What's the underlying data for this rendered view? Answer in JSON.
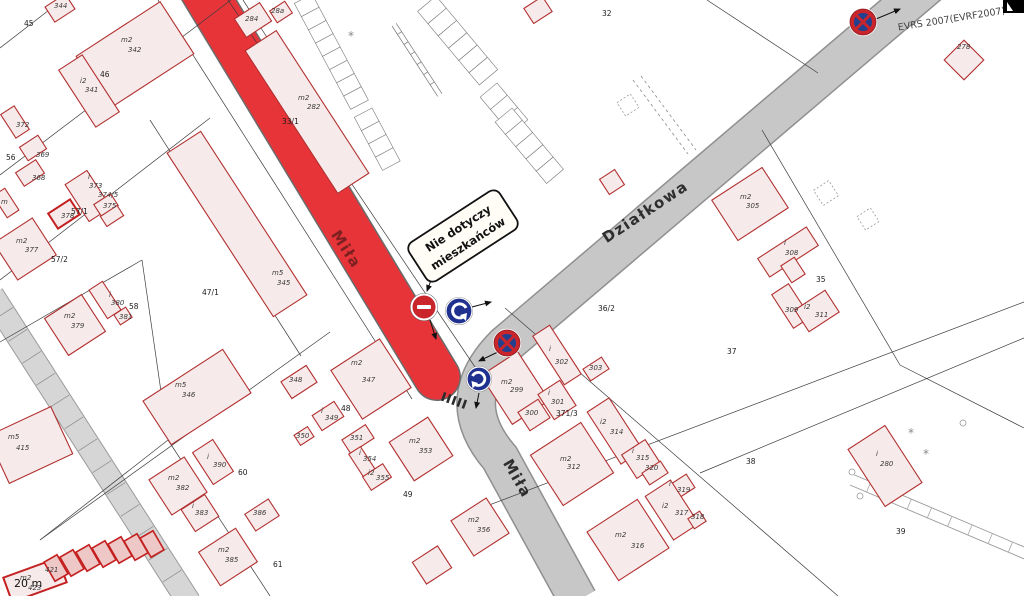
{
  "streets": {
    "mila_north": "Miła",
    "dzialkowa": "Działkowa",
    "mila_south": "Miła"
  },
  "annotation": {
    "line1": "Nie dotyczy",
    "line2": "mieszkańców"
  },
  "datum_note": "EVRS 2007(EVRF2007)",
  "scale_label": "20 m",
  "colors": {
    "closed_road": "#e73439",
    "road": "#c7c7c7",
    "building_fill": "#f7eaea",
    "building_stroke": "#b23030",
    "sign_blue": "#20308f",
    "sign_red": "#c9252b"
  },
  "signs": [
    {
      "name": "no-entry-sign",
      "x": 424,
      "y": 307
    },
    {
      "name": "mandatory-direction-left-sign",
      "x": 459,
      "y": 311
    },
    {
      "name": "no-stopping-sign",
      "x": 507,
      "y": 343
    },
    {
      "name": "mandatory-direction-right-sign",
      "x": 479,
      "y": 379
    },
    {
      "name": "no-stopping-sign",
      "x": 863,
      "y": 22
    }
  ],
  "map_geometry": {
    "buildings": [
      [
        135,
        55,
        100,
        62,
        -33
      ],
      [
        89,
        91,
        28,
        68,
        -33
      ],
      [
        60,
        8,
        24,
        18,
        -33
      ],
      [
        253,
        20,
        30,
        22,
        -33
      ],
      [
        281,
        12,
        18,
        14,
        -33
      ],
      [
        307,
        112,
        170,
        37,
        57
      ],
      [
        237,
        224,
        195,
        40,
        57
      ],
      [
        197,
        397,
        95,
        52,
        -33
      ],
      [
        25,
        249,
        46,
        44,
        -33
      ],
      [
        75,
        325,
        44,
        44,
        -33
      ],
      [
        88,
        196,
        26,
        44,
        -33
      ],
      [
        106,
        205,
        20,
        14,
        -33
      ],
      [
        112,
        216,
        20,
        12,
        -33
      ],
      [
        64,
        214,
        26,
        18,
        -33,
        "bold"
      ],
      [
        33,
        148,
        22,
        16,
        -33
      ],
      [
        30,
        173,
        24,
        16,
        -33
      ],
      [
        15,
        122,
        16,
        28,
        -33
      ],
      [
        6,
        203,
        14,
        26,
        -33
      ],
      [
        105,
        300,
        16,
        34,
        -33
      ],
      [
        123,
        316,
        14,
        12,
        -33
      ],
      [
        299,
        382,
        30,
        20,
        -33
      ],
      [
        371,
        379,
        58,
        58,
        -33
      ],
      [
        328,
        416,
        26,
        18,
        -33
      ],
      [
        304,
        436,
        16,
        12,
        -33
      ],
      [
        358,
        439,
        28,
        16,
        -33
      ],
      [
        366,
        468,
        42,
        14,
        57
      ],
      [
        377,
        477,
        24,
        16,
        -33
      ],
      [
        421,
        449,
        46,
        46,
        -33
      ],
      [
        178,
        486,
        42,
        42,
        -33
      ],
      [
        200,
        513,
        28,
        26,
        -33
      ],
      [
        213,
        462,
        38,
        24,
        57
      ],
      [
        228,
        557,
        44,
        40,
        -33
      ],
      [
        262,
        515,
        28,
        20,
        -33
      ],
      [
        30,
        445,
        70,
        52,
        -25
      ],
      [
        35,
        580,
        58,
        26,
        -20,
        "bold"
      ],
      [
        56,
        568,
        15,
        22,
        -30,
        "hb"
      ],
      [
        72,
        563,
        15,
        22,
        -30,
        "hb"
      ],
      [
        88,
        558,
        15,
        22,
        -30,
        "hb"
      ],
      [
        104,
        554,
        15,
        22,
        -30,
        "hb"
      ],
      [
        120,
        550,
        15,
        22,
        -30,
        "hb"
      ],
      [
        136,
        547,
        15,
        22,
        -30,
        "hb"
      ],
      [
        152,
        544,
        15,
        22,
        -30,
        "hb"
      ],
      [
        432,
        565,
        30,
        26,
        -33
      ],
      [
        480,
        527,
        42,
        42,
        -33
      ],
      [
        572,
        464,
        60,
        60,
        -33
      ],
      [
        615,
        431,
        26,
        62,
        -33
      ],
      [
        641,
        459,
        28,
        28,
        -33
      ],
      [
        655,
        473,
        22,
        14,
        -33
      ],
      [
        678,
        489,
        30,
        16,
        -33
      ],
      [
        672,
        510,
        30,
        52,
        -33
      ],
      [
        697,
        520,
        14,
        12,
        -33
      ],
      [
        628,
        540,
        60,
        58,
        -33
      ],
      [
        515,
        388,
        44,
        58,
        -33
      ],
      [
        534,
        415,
        24,
        22,
        -33
      ],
      [
        557,
        400,
        26,
        30,
        -33
      ],
      [
        557,
        355,
        20,
        58,
        -33
      ],
      [
        596,
        369,
        22,
        14,
        -33
      ],
      [
        750,
        204,
        60,
        48,
        -33
      ],
      [
        788,
        252,
        58,
        22,
        -33
      ],
      [
        793,
        270,
        16,
        20,
        -33
      ],
      [
        791,
        306,
        20,
        40,
        -33
      ],
      [
        817,
        311,
        36,
        26,
        -33
      ],
      [
        885,
        466,
        44,
        68,
        -33
      ],
      [
        964,
        60,
        28,
        28,
        -45
      ],
      [
        538,
        10,
        22,
        18,
        -33
      ],
      [
        612,
        182,
        18,
        18,
        -33
      ]
    ],
    "labels": [
      [
        "45",
        24,
        26,
        "p"
      ],
      [
        "46",
        100,
        77,
        "p"
      ],
      [
        "32",
        602,
        16,
        "p"
      ],
      [
        "33/1",
        282,
        124,
        "p"
      ],
      [
        "47/1",
        202,
        295,
        "p"
      ],
      [
        "56",
        6,
        160,
        "p"
      ],
      [
        "57/1",
        71,
        214,
        "p"
      ],
      [
        "57/2",
        51,
        262,
        "p"
      ],
      [
        "58",
        129,
        309,
        "p"
      ],
      [
        "60",
        238,
        475,
        "p"
      ],
      [
        "61",
        273,
        567,
        "p"
      ],
      [
        "48",
        341,
        411,
        "p"
      ],
      [
        "49",
        403,
        497,
        "p"
      ],
      [
        "35",
        816,
        282,
        "p"
      ],
      [
        "36/2",
        598,
        311,
        "p"
      ],
      [
        "37",
        727,
        354,
        "p"
      ],
      [
        "38",
        746,
        464,
        "p"
      ],
      [
        "39",
        896,
        534,
        "p"
      ],
      [
        "371/3",
        556,
        416,
        "p"
      ],
      [
        "m2",
        121,
        42,
        "b"
      ],
      [
        "342",
        128,
        52,
        "b"
      ],
      [
        "i2",
        80,
        83,
        "b"
      ],
      [
        "341",
        85,
        92,
        "b"
      ],
      [
        "344",
        54,
        8,
        "b"
      ],
      [
        "284",
        245,
        21,
        "b"
      ],
      [
        "28a",
        271,
        13,
        "b"
      ],
      [
        "m2",
        298,
        100,
        "b"
      ],
      [
        "282",
        307,
        109,
        "b"
      ],
      [
        "m5",
        272,
        275,
        "b"
      ],
      [
        "345",
        277,
        285,
        "b"
      ],
      [
        "m5",
        175,
        387,
        "b"
      ],
      [
        "346",
        182,
        397,
        "b"
      ],
      [
        "m2",
        16,
        243,
        "b"
      ],
      [
        "377",
        25,
        252,
        "b"
      ],
      [
        "m2",
        64,
        318,
        "b"
      ],
      [
        "379",
        71,
        328,
        "b"
      ],
      [
        "i",
        88,
        179,
        "b"
      ],
      [
        "373",
        89,
        188,
        "b"
      ],
      [
        "374/5",
        98,
        197,
        "b"
      ],
      [
        "375",
        103,
        208,
        "b"
      ],
      [
        "378",
        61,
        218,
        "b"
      ],
      [
        "369",
        36,
        157,
        "b"
      ],
      [
        "368",
        32,
        180,
        "b"
      ],
      [
        "372",
        16,
        127,
        "b"
      ],
      [
        "m",
        1,
        204,
        "b"
      ],
      [
        "i",
        109,
        297,
        "b"
      ],
      [
        "380",
        111,
        305,
        "b"
      ],
      [
        "381",
        119,
        319,
        "b"
      ],
      [
        "348",
        289,
        382,
        "b"
      ],
      [
        "m2",
        351,
        365,
        "b"
      ],
      [
        "347",
        362,
        382,
        "b"
      ],
      [
        "i",
        321,
        413,
        "b"
      ],
      [
        "349",
        325,
        420,
        "b"
      ],
      [
        "350",
        296,
        438,
        "b"
      ],
      [
        "351",
        350,
        440,
        "b"
      ],
      [
        "i",
        359,
        455,
        "b"
      ],
      [
        "354",
        363,
        461,
        "b"
      ],
      [
        "i2",
        368,
        475,
        "b"
      ],
      [
        "355",
        376,
        480,
        "b"
      ],
      [
        "m2",
        409,
        443,
        "b"
      ],
      [
        "353",
        419,
        453,
        "b"
      ],
      [
        "m2",
        168,
        480,
        "b"
      ],
      [
        "382",
        176,
        490,
        "b"
      ],
      [
        "i",
        192,
        508,
        "b"
      ],
      [
        "383",
        195,
        515,
        "b"
      ],
      [
        "i",
        207,
        459,
        "b"
      ],
      [
        "390",
        213,
        467,
        "b"
      ],
      [
        "m2",
        218,
        552,
        "b"
      ],
      [
        "385",
        225,
        562,
        "b"
      ],
      [
        "386",
        253,
        515,
        "b"
      ],
      [
        "m5",
        8,
        439,
        "b"
      ],
      [
        "415",
        16,
        450,
        "b"
      ],
      [
        "421",
        45,
        572,
        "b"
      ],
      [
        "m2",
        20,
        580,
        "b"
      ],
      [
        "423",
        28,
        590,
        "b"
      ],
      [
        "m2",
        468,
        522,
        "b"
      ],
      [
        "356",
        477,
        532,
        "b"
      ],
      [
        "m2",
        560,
        461,
        "b"
      ],
      [
        "312",
        567,
        469,
        "b"
      ],
      [
        "i2",
        600,
        424,
        "b"
      ],
      [
        "314",
        610,
        434,
        "b"
      ],
      [
        "i",
        632,
        453,
        "b"
      ],
      [
        "315",
        636,
        460,
        "b"
      ],
      [
        "320",
        645,
        470,
        "b"
      ],
      [
        "i",
        669,
        486,
        "b"
      ],
      [
        "319",
        677,
        492,
        "b"
      ],
      [
        "i2",
        662,
        508,
        "b"
      ],
      [
        "317",
        675,
        515,
        "b"
      ],
      [
        "318",
        691,
        519,
        "b"
      ],
      [
        "m2",
        615,
        537,
        "b"
      ],
      [
        "316",
        631,
        548,
        "b"
      ],
      [
        "m2",
        501,
        384,
        "b"
      ],
      [
        "299",
        510,
        392,
        "b"
      ],
      [
        "300",
        525,
        415,
        "b"
      ],
      [
        "i",
        548,
        395,
        "b"
      ],
      [
        "301",
        551,
        404,
        "b"
      ],
      [
        "i",
        549,
        351,
        "b"
      ],
      [
        "302",
        555,
        364,
        "b"
      ],
      [
        "303",
        589,
        370,
        "b"
      ],
      [
        "m2",
        740,
        199,
        "b"
      ],
      [
        "305",
        746,
        208,
        "b"
      ],
      [
        "i",
        784,
        245,
        "b"
      ],
      [
        "308",
        785,
        255,
        "b"
      ],
      [
        "309",
        785,
        312,
        "b"
      ],
      [
        "i2",
        804,
        309,
        "b"
      ],
      [
        "311",
        815,
        317,
        "b"
      ],
      [
        "i",
        876,
        456,
        "b"
      ],
      [
        "280",
        880,
        466,
        "b"
      ],
      [
        "278",
        957,
        49,
        "b"
      ]
    ],
    "stall_rows": [
      [
        436,
        -4,
        50,
        6,
        16,
        24
      ],
      [
        497,
        83,
        50,
        3,
        16,
        22
      ],
      [
        512,
        108,
        50,
        5,
        16,
        22
      ],
      [
        312,
        -6,
        62,
        8,
        15,
        20
      ],
      [
        372,
        108,
        62,
        4,
        15,
        20
      ]
    ],
    "dashed_boxes": [
      [
        826,
        193,
        18
      ],
      [
        868,
        219,
        16
      ],
      [
        628,
        105,
        16
      ]
    ],
    "stars": [
      [
        348,
        40
      ],
      [
        908,
        437
      ],
      [
        923,
        458
      ]
    ],
    "circles": [
      [
        963,
        423
      ],
      [
        852,
        472
      ],
      [
        860,
        496
      ]
    ]
  }
}
